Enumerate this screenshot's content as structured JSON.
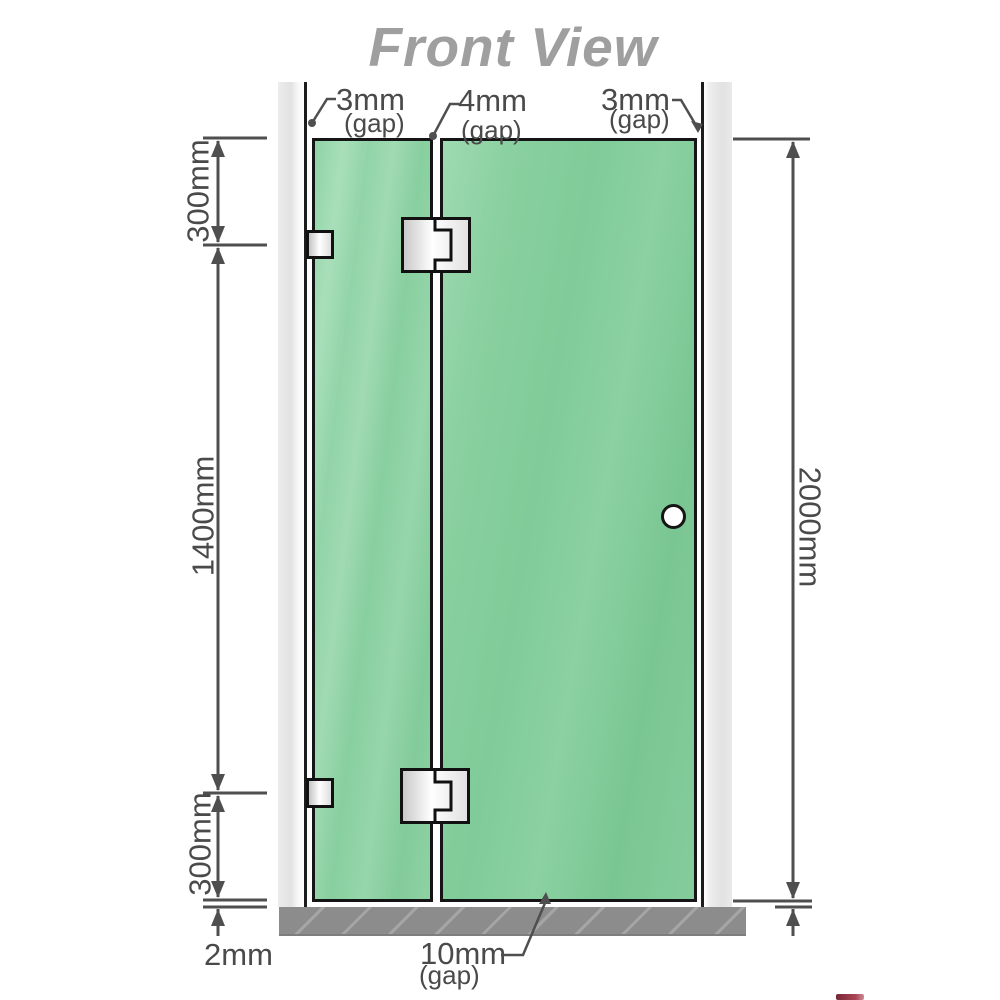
{
  "title": "Front View",
  "top_gap_labels": [
    {
      "value": "3mm",
      "note": "(gap)"
    },
    {
      "value": "4mm",
      "note": "(gap)"
    },
    {
      "value": "3mm",
      "note": "(gap)"
    }
  ],
  "side_dimensions": {
    "left_top": "300mm",
    "left_middle": "1400mm",
    "left_bottom": "300mm",
    "right": "2000mm"
  },
  "bottom_labels": {
    "floor_gap": "2mm",
    "door_bottom_gap": {
      "value": "10mm",
      "note": "(gap)"
    }
  },
  "colors": {
    "glass_green": "#8bd0a2",
    "wall_gray": "#e4e4e4",
    "floor_gray": "#8c8c8c",
    "dimension_line": "#4f4f4f",
    "title_gray": "#9f9f9f",
    "hardware_metal": "#e8e8e8"
  }
}
